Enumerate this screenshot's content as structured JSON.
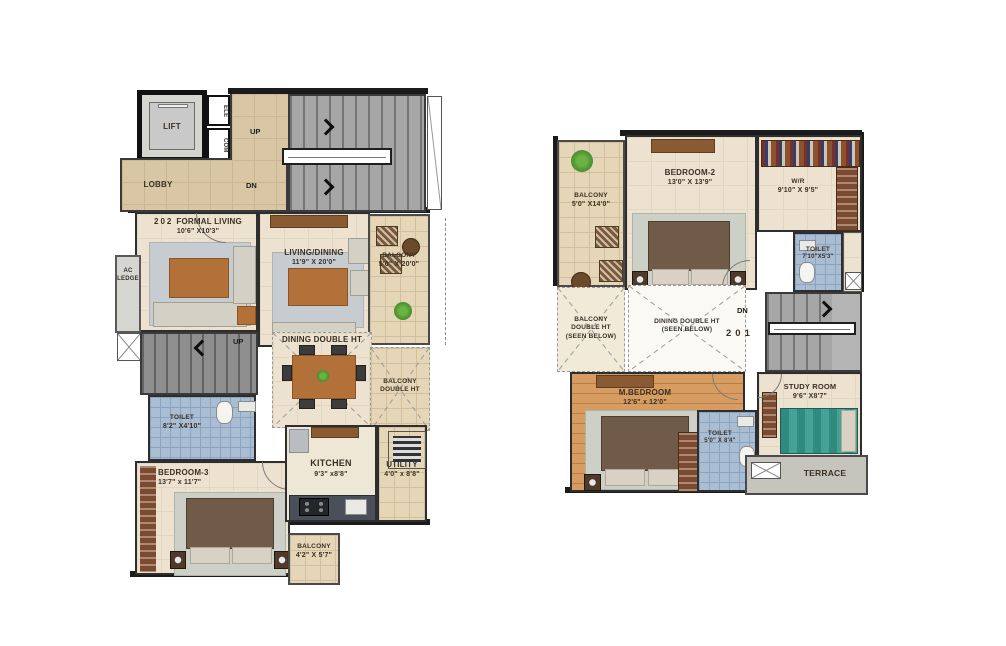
{
  "colors": {
    "wall": "#1b1b1b",
    "floor_beige": "#ece2cf",
    "lobby_tan": "#d8c6a4",
    "balcony_tile": "#e5d6b8",
    "toilet_blue": "#a9bdd3",
    "stair_gray": "#a6a6a6",
    "wood_floor": "#d69c62",
    "bed_brown": "#6f5b47",
    "plant_green": "#4f9633"
  },
  "plan202": {
    "unit": "202",
    "lift": "LIFT",
    "shaft_top": "ELE",
    "shaft_bottom": "COM",
    "lobby": "LOBBY",
    "stairs_up": "UP",
    "stairs_dn": "DN",
    "inner_stairs_up": "UP",
    "ac_ledge_line1": "AC",
    "ac_ledge_line2": "LEDGE",
    "formal_living": {
      "label": "FORMAL LIVING",
      "dims": "10'6\" X10'3\""
    },
    "living_dining": {
      "label": "LIVING/DINING",
      "dims": "11'9\" X 20'0\""
    },
    "balcony_side": {
      "label": "BALCONY",
      "dims": "5'0\" X 20'0\""
    },
    "dining_double_ht": "DINING DOUBLE HT",
    "balcony_double_ht_line1": "BALCONY",
    "balcony_double_ht_line2": "DOUBLE HT",
    "toilet": {
      "label": "TOILET",
      "dims": "8'2\" X4'10\""
    },
    "bedroom3": {
      "label": "BEDROOM-3",
      "dims": "13'7\" x 11'7\""
    },
    "kitchen": {
      "label": "KITCHEN",
      "dims": "9'3\" x8'8\""
    },
    "utility": {
      "label": "UTILITY",
      "dims": "4'0\" x 8'8\""
    },
    "balcony_rear": {
      "label": "BALCONY",
      "dims": "4'2\" X 5'7\""
    }
  },
  "plan201": {
    "unit": "201",
    "stairs_dn": "DN",
    "balcony": {
      "label": "BALCONY",
      "dims": "5'0\" X14'0\""
    },
    "bedroom2": {
      "label": "BEDROOM-2",
      "dims": "13'0\" X 13'9\""
    },
    "wr": {
      "label": "W/R",
      "dims": "9'10\" X 9'5\""
    },
    "toilet_top": {
      "label": "TOILET",
      "dims": "7'10\"X5'3\""
    },
    "balcony_double_ht_line1": "BALCONY",
    "balcony_double_ht_line2": "DOUBLE HT",
    "balcony_double_ht_line3": "(SEEN BELOW)",
    "dining_double_ht_line1": "DINING DOUBLE HT",
    "dining_double_ht_line2": "(SEEN BELOW)",
    "m_bedroom": {
      "label": "M.BEDROOM",
      "dims": "12'6\" x 12'0\""
    },
    "toilet_bottom": {
      "label": "TOILET",
      "dims": "5'0\" X 8'4\""
    },
    "study_room": {
      "label": "STUDY ROOM",
      "dims": "9'6\" X8'7\""
    },
    "terrace": "TERRACE"
  }
}
